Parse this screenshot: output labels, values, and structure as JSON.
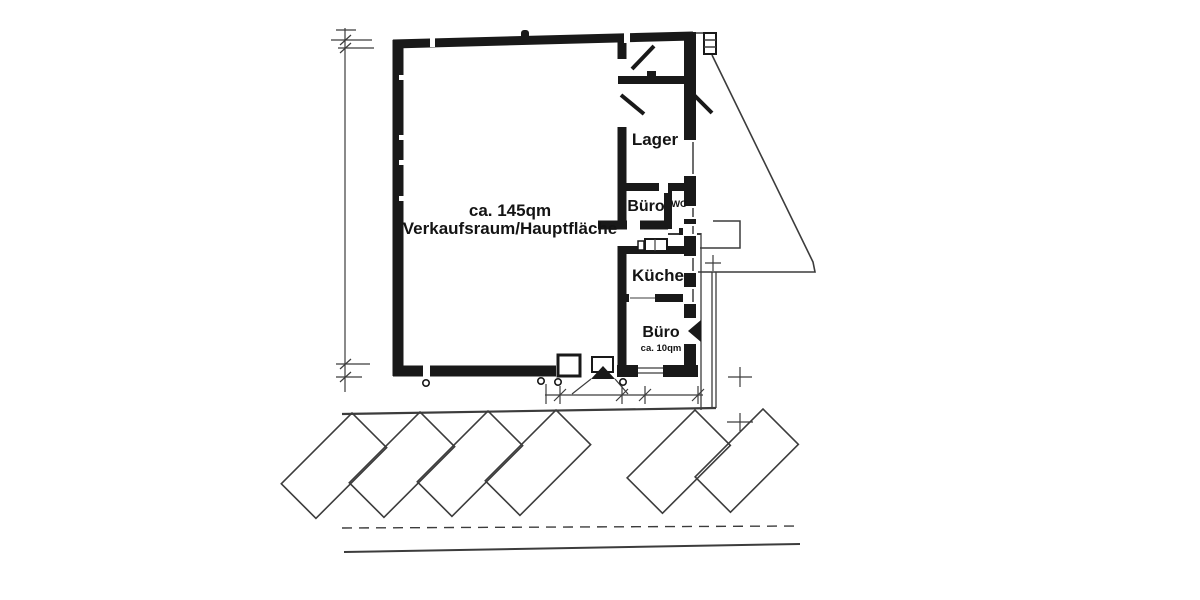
{
  "plan": {
    "labels": {
      "main_room": {
        "line1": "ca. 145qm",
        "line2": "Verkaufsraum/Hauptfläche"
      },
      "lager": "Lager",
      "buero_1": "Büro",
      "wc": "WC",
      "kueche": "Küche",
      "buero_2": "Büro",
      "buero_2_area": "ca. 10qm"
    },
    "colors": {
      "wall": "#191919",
      "line": "#3c3c3c",
      "ink": "#141414",
      "paper": "#ffffff"
    }
  }
}
